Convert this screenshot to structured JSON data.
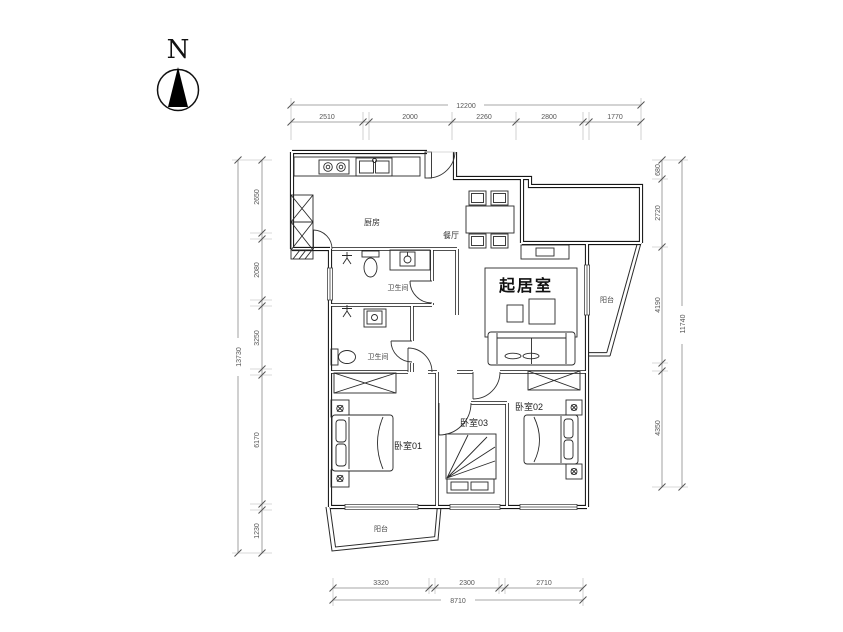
{
  "compass": {
    "label": "N"
  },
  "rooms": {
    "living": "起居室",
    "kitchen": "厨房",
    "dining": "餐厅",
    "bath_upper": "卫生间",
    "bath_lower": "卫生间",
    "bedroom1": "卧室01",
    "bedroom2": "卧室02",
    "bedroom3": "卧室03",
    "balcony_right": "阳台",
    "balcony_bottom": "阳台"
  },
  "dimensions": {
    "top": {
      "total": "12200",
      "segments": [
        "2510",
        "2000",
        "2260",
        "2800",
        "1770"
      ]
    },
    "bottom": {
      "total": "8710",
      "segments": [
        "3320",
        "2300",
        "2710"
      ]
    },
    "left": {
      "total": "13730",
      "segments": [
        "2650",
        "2080",
        "3250",
        "6170",
        "1230"
      ]
    },
    "right": {
      "total": "11740",
      "segments": [
        "680",
        "2720",
        "4190",
        "4350"
      ]
    }
  }
}
